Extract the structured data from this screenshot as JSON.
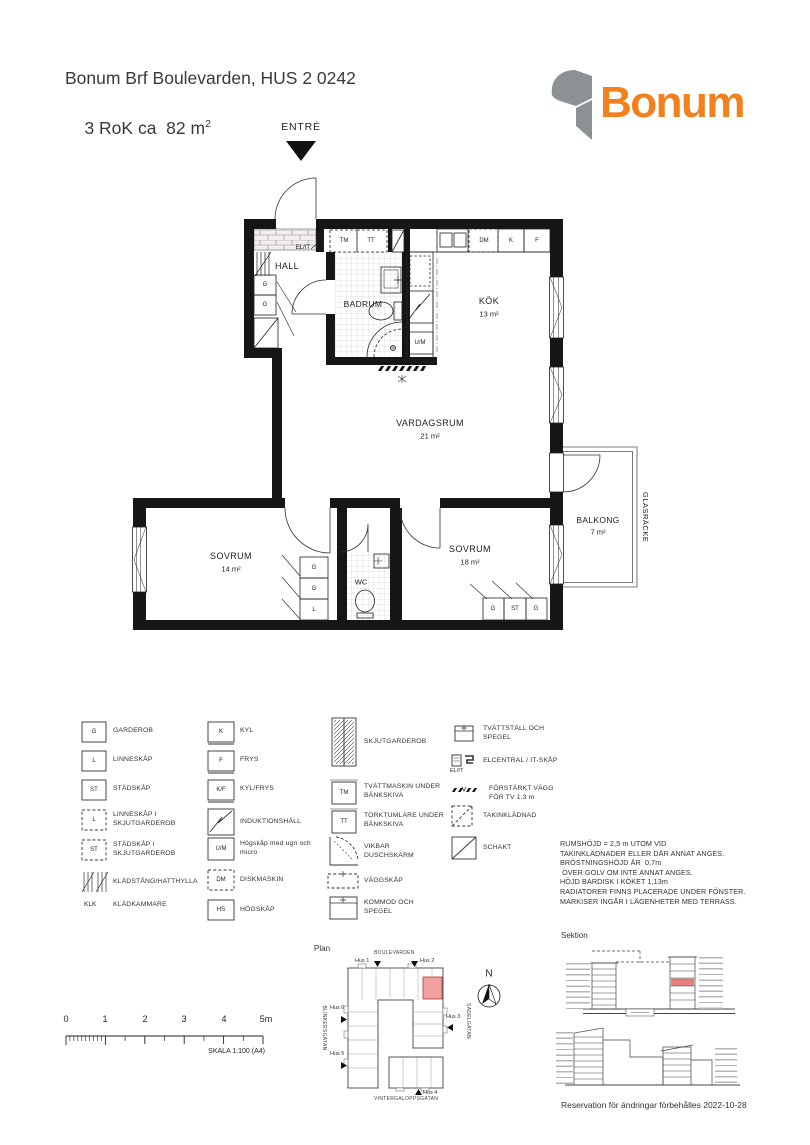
{
  "header": {
    "title_line1": "Bonum Brf Boulevarden, HUS 2 0242",
    "title_line2_base": "3 RoK ca  82 m",
    "title_line2_sup": "2",
    "logo_text": "Bonum",
    "logo_color": "#F1801D"
  },
  "plan": {
    "entry": "ENTRÉ",
    "rooms": {
      "hall": "HALL",
      "badrum": "BADRUM",
      "kok": "KÖK",
      "kok_area": "13 m²",
      "vardagsrum": "VARDAGSRUM",
      "vardagsrum_area": "21 m²",
      "sovrum_small": "SOVRUM",
      "sovrum_small_area": "14 m²",
      "sovrum_large": "SOVRUM",
      "sovrum_large_area": "18 m²",
      "wc": "WC",
      "balkong": "BALKONG",
      "balkong_area": "7 m²",
      "glasracke": "GLASRÄCKE"
    },
    "fixtures": {
      "g": "G",
      "l": "L",
      "st": "ST",
      "tm": "TM",
      "tt": "TT",
      "dm": "DM",
      "k": "K",
      "f": "F",
      "um": "U/M",
      "elit": "EL/IT"
    }
  },
  "legend": {
    "col1": [
      {
        "symbol": "G",
        "label": "GARDEROB"
      },
      {
        "symbol": "L",
        "label": "LINNESKÅP"
      },
      {
        "symbol": "ST",
        "label": "STÄDSKÅP"
      },
      {
        "symbol": "L",
        "label": "LINNESKÅP I SKJUTGARDEROB"
      },
      {
        "symbol": "ST",
        "label": "STÄDSKÅP I SKJUTGARDEROB"
      },
      {
        "symbol": "",
        "label": "KLÄDSTÅNG/HATTHYLLA"
      },
      {
        "symbol": "KLK",
        "label": "KLÄDKAMMARE"
      }
    ],
    "col2": [
      {
        "symbol": "K",
        "label": "KYL"
      },
      {
        "symbol": "F",
        "label": "FRYS"
      },
      {
        "symbol": "K/F",
        "label": "KYL/FRYS"
      },
      {
        "symbol": "",
        "label": "INDUKTIONSHÄLL"
      },
      {
        "symbol": "U/M",
        "label": "Högskåp med ugn och micro"
      },
      {
        "symbol": "DM",
        "label": "DISKMASKIN"
      },
      {
        "symbol": "HS",
        "label": "HÖGSKÅP"
      }
    ],
    "col3": [
      {
        "symbol": "",
        "label": "SKJUTGARDEROB"
      },
      {
        "symbol": "TM",
        "label": "TVÄTTMASKIN UNDER BÄNKSKIVA"
      },
      {
        "symbol": "TT",
        "label": "TORKTUMLARE UNDER BÄNKSKIVA"
      },
      {
        "symbol": "",
        "label": "VIKBAR DUSCHSKÄRM"
      },
      {
        "symbol": "",
        "label": "VÄGGSKÅP"
      },
      {
        "symbol": "",
        "label": "KOMMOD OCH SPEGEL"
      }
    ],
    "col4": [
      {
        "symbol": "",
        "label": "TVÄTTSTÄLL OCH SPEGEL"
      },
      {
        "symbol": "EL/IT",
        "label": "ELCENTRAL / IT-SKÅP"
      },
      {
        "symbol": "",
        "label": "FÖRSTÄRKT VÄGG FÖR TV 1.3 m"
      },
      {
        "symbol": "",
        "label": "TAKINKLÄDNAD"
      },
      {
        "symbol": "",
        "label": "SCHAKT"
      }
    ]
  },
  "notes": [
    "RUMSHÖJD = 2,5 m UTOM VID",
    "TAKINKLÄDNADER ELLER DÄR ANNAT ANGES.",
    "BRÖSTNINGSHÖJD ÄR  0,7m",
    " ÖVER GOLV OM INTE ANNAT ANGES.",
    "HÖJD BARDISK I KÖKET 1,13m",
    "RADIATORER FINNS PLACERADE UNDER FÖNSTER.",
    "MARKISER INGÅR I LÄGENHETER MED TERRASS."
  ],
  "scalebar": {
    "labels": [
      "0",
      "1",
      "2",
      "3",
      "4",
      "5m"
    ],
    "caption": "SKALA 1:100 (A4)"
  },
  "siteplan": {
    "title": "Plan",
    "streets": {
      "north": "BOULEVARDEN",
      "west": "BLINKERSGATAN",
      "east": "SADELGATAN",
      "south": "VINTERGALOPPSGATAN"
    },
    "houses": {
      "hus1": "Hus 1",
      "hus2": "Hus 2",
      "hus3": "Hus 3",
      "hus4": "Hus 4",
      "hus5": "Hus 5",
      "hus6": "Hus 6"
    },
    "compass": "N",
    "highlight_color": "#F2A1A1"
  },
  "sektion": {
    "title": "Sektion",
    "reservation": "Reservation för ändringar förbehålles 2022-10-28",
    "highlight_color": "#E98080"
  }
}
